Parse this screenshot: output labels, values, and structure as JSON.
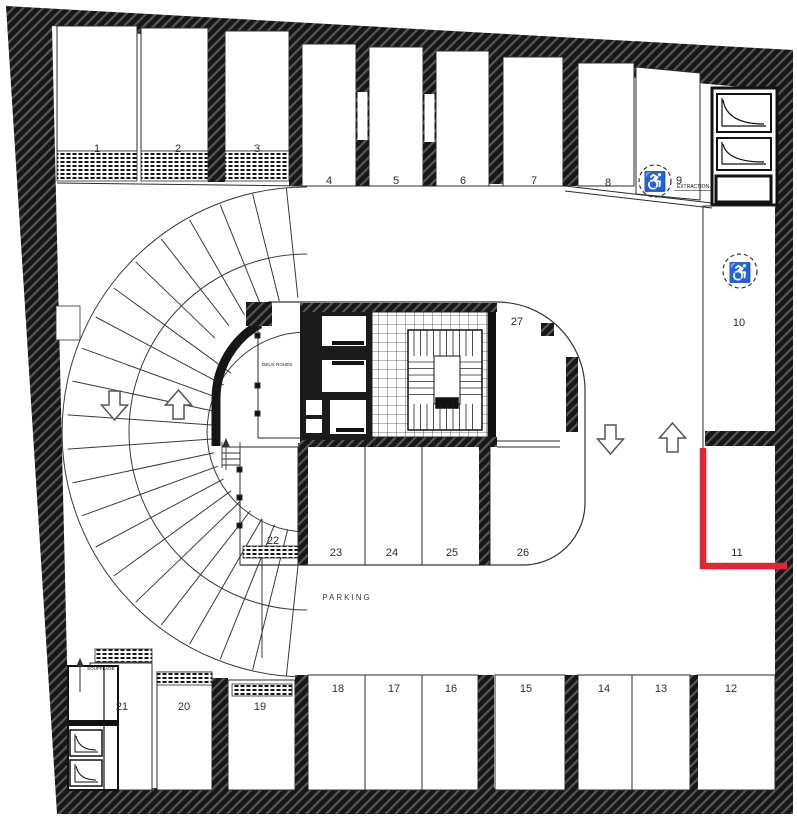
{
  "plan": {
    "space_numbers": [
      "1",
      "2",
      "3",
      "4",
      "5",
      "6",
      "7",
      "8",
      "9",
      "10",
      "11",
      "12",
      "13",
      "14",
      "15",
      "16",
      "17",
      "18",
      "19",
      "20",
      "21",
      "22",
      "23",
      "24",
      "25",
      "26",
      "27"
    ],
    "labels": {
      "parking": "PARKING",
      "extraction": "EXTRACTION",
      "soufflage": "SOUFFLAGE",
      "deux_roues": "DEUX ROUES"
    },
    "icons": {
      "wheelchair": "♿"
    },
    "colors": {
      "highlight": "#e02633",
      "wall": "#171717"
    }
  }
}
